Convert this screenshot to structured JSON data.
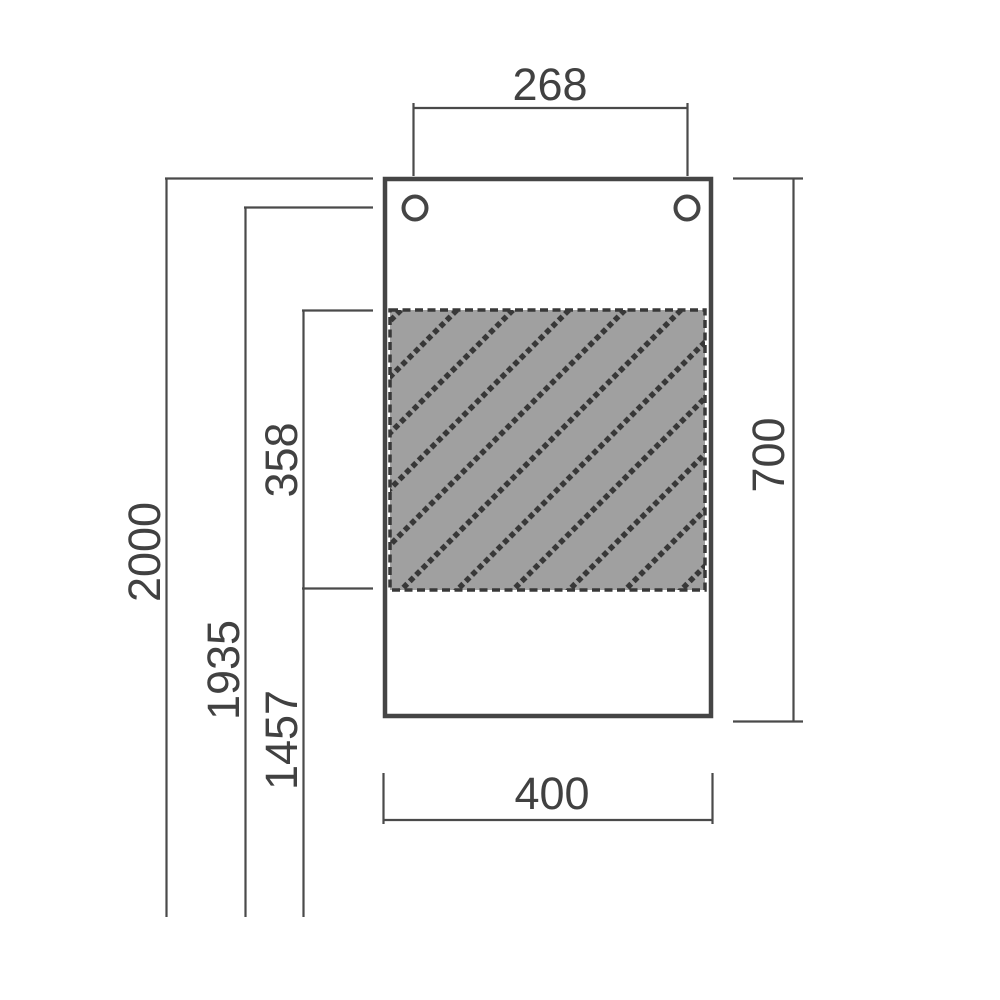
{
  "drawing": {
    "type": "dimensioned technical drawing of a rectangular panel with two mounting holes and a hatched region",
    "dimensions": {
      "hole_spacing": "268",
      "overall_height": "2000",
      "hole_center_height": "1935",
      "below_hatch_height": "1457",
      "hatch_height": "358",
      "panel_height": "700",
      "panel_width": "400"
    },
    "colors": {
      "line": "#4a4a4a",
      "panel": "#454545",
      "text": "#414141",
      "hatchFill": "#a0a0a0",
      "hatchStroke": "#383838",
      "background": "#ffffff"
    }
  }
}
